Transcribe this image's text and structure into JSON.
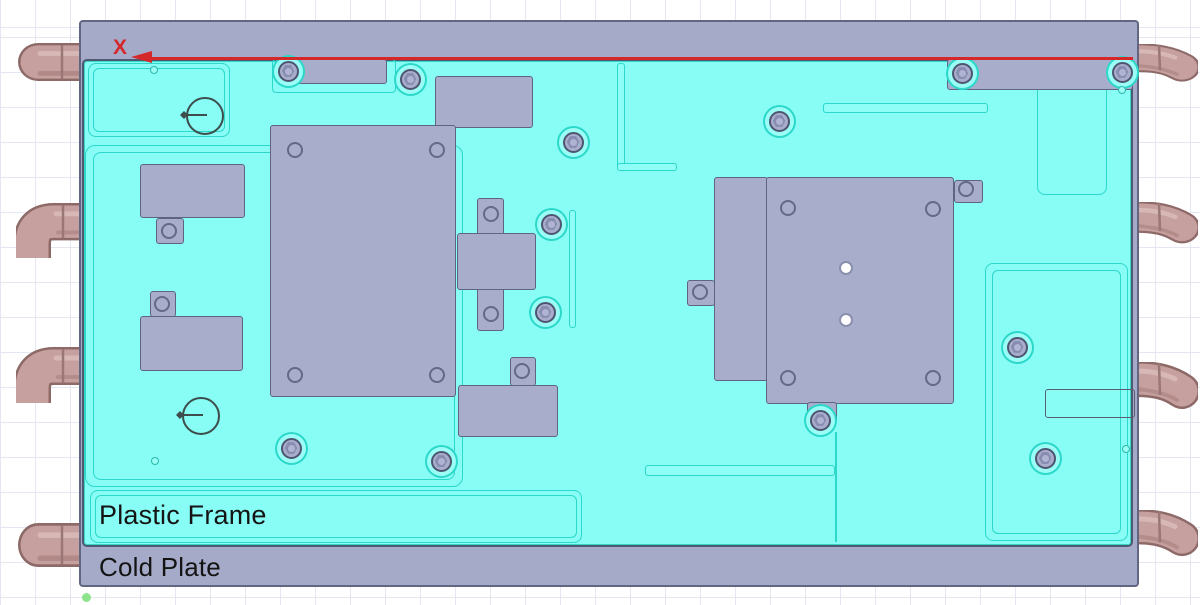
{
  "labels": {
    "plastic_frame": "Plastic Frame",
    "cold_plate": "Cold Plate",
    "axis_x": "X"
  },
  "colors": {
    "frame_cyan": "#87fdf5",
    "plate_gray": "#a5aac9",
    "component_gray": "#a8adcb",
    "pipe_body": "#c6a09e",
    "pipe_edge": "#8d6a68",
    "axis_red": "#d5282b",
    "outline_teal": "#2bd8ca",
    "outline_dark": "#5f6480",
    "grid_line": "#e4e6f2",
    "background": "#ffffff",
    "origin_green": "#7fe27f",
    "hole_white": "#ffffff"
  },
  "outlines": [
    {
      "name": "top-left-panel-outline",
      "x": 88,
      "y": 63,
      "w": 142,
      "h": 74,
      "r": 8
    },
    {
      "name": "top-left-panel-outline-inner",
      "x": 93,
      "y": 68,
      "w": 132,
      "h": 64,
      "r": 6
    },
    {
      "name": "top-mount-outline",
      "x": 272,
      "y": 59,
      "w": 124,
      "h": 34,
      "r": 4
    },
    {
      "name": "left-main-panel-outline",
      "x": 85,
      "y": 145,
      "w": 378,
      "h": 342,
      "r": 10
    },
    {
      "name": "left-main-panel-outline-inner",
      "x": 93,
      "y": 152,
      "w": 362,
      "h": 328,
      "r": 8
    },
    {
      "name": "label-panel-outline",
      "x": 90,
      "y": 490,
      "w": 492,
      "h": 53,
      "r": 8
    },
    {
      "name": "label-panel-outline-inner",
      "x": 95,
      "y": 495,
      "w": 482,
      "h": 43,
      "r": 6
    },
    {
      "name": "top-right-panel-outline",
      "x": 1037,
      "y": 63,
      "w": 70,
      "h": 132,
      "r": 8
    },
    {
      "name": "lower-right-panel-outline",
      "x": 985,
      "y": 263,
      "w": 143,
      "h": 278,
      "r": 8
    },
    {
      "name": "lower-right-panel-outline-inner",
      "x": 992,
      "y": 270,
      "w": 129,
      "h": 264,
      "r": 6
    }
  ],
  "slots": [
    {
      "name": "slot-top-right",
      "x": 823,
      "y": 103,
      "w": 165,
      "h": 10
    },
    {
      "name": "slot-bottom-middle",
      "x": 645,
      "y": 465,
      "w": 190,
      "h": 11
    },
    {
      "name": "slot-vertical",
      "x": 569,
      "y": 210,
      "w": 7,
      "h": 118
    },
    {
      "name": "l-wall-vertical",
      "x": 617,
      "y": 63,
      "w": 8,
      "h": 107
    },
    {
      "name": "l-wall-horizontal",
      "x": 617,
      "y": 163,
      "w": 60,
      "h": 8
    }
  ],
  "dark_slot": {
    "name": "vent-slot-outline",
    "x": 1045,
    "y": 389,
    "w": 90,
    "h": 29
  },
  "lines": [
    {
      "name": "right-module-divider",
      "x": 765,
      "y": 178,
      "w": 2,
      "h": 202,
      "color": "dark"
    },
    {
      "name": "bottom-panel-divider",
      "x": 835,
      "y": 432,
      "w": 2,
      "h": 110,
      "color": "teal"
    }
  ],
  "blocks": [
    {
      "name": "top-mount-block",
      "x": 278,
      "y": 59,
      "w": 109,
      "h": 25
    },
    {
      "name": "top-right-band",
      "x": 947,
      "y": 59,
      "w": 186,
      "h": 31
    },
    {
      "name": "upper-mid-block",
      "x": 435,
      "y": 76,
      "w": 98,
      "h": 52
    },
    {
      "name": "large-left-module",
      "x": 270,
      "y": 125,
      "w": 186,
      "h": 272
    },
    {
      "name": "cross-module-vertical",
      "x": 477,
      "y": 198,
      "w": 27,
      "h": 133
    },
    {
      "name": "cross-module-horizontal",
      "x": 457,
      "y": 233,
      "w": 79,
      "h": 57
    },
    {
      "name": "lower-ext-tab",
      "x": 510,
      "y": 357,
      "w": 26,
      "h": 29
    },
    {
      "name": "lower-ext-block",
      "x": 458,
      "y": 385,
      "w": 100,
      "h": 52
    },
    {
      "name": "small-block-upper",
      "x": 140,
      "y": 164,
      "w": 105,
      "h": 54
    },
    {
      "name": "small-block-upper-tab",
      "x": 156,
      "y": 218,
      "w": 28,
      "h": 26
    },
    {
      "name": "small-block-lower-tab",
      "x": 150,
      "y": 291,
      "w": 26,
      "h": 26
    },
    {
      "name": "small-block-lower",
      "x": 140,
      "y": 316,
      "w": 103,
      "h": 55
    },
    {
      "name": "right-module-left-strip",
      "x": 714,
      "y": 177,
      "w": 54,
      "h": 204
    },
    {
      "name": "right-module-main",
      "x": 766,
      "y": 177,
      "w": 188,
      "h": 227
    },
    {
      "name": "right-module-tab-top",
      "x": 954,
      "y": 180,
      "w": 29,
      "h": 23
    },
    {
      "name": "right-module-tab-left",
      "x": 687,
      "y": 280,
      "w": 28,
      "h": 26
    },
    {
      "name": "right-module-tab-bottom",
      "x": 807,
      "y": 402,
      "w": 30,
      "h": 21
    }
  ],
  "screws": [
    {
      "x": 288,
      "y": 71
    },
    {
      "x": 410,
      "y": 79
    },
    {
      "x": 962,
      "y": 73
    },
    {
      "x": 1122,
      "y": 72
    },
    {
      "x": 573,
      "y": 142
    },
    {
      "x": 779,
      "y": 121
    },
    {
      "x": 551,
      "y": 224
    },
    {
      "x": 545,
      "y": 312
    },
    {
      "x": 291,
      "y": 448
    },
    {
      "x": 441,
      "y": 461
    },
    {
      "x": 1017,
      "y": 347
    },
    {
      "x": 1045,
      "y": 458
    },
    {
      "x": 820,
      "y": 420
    }
  ],
  "holes": [
    {
      "x": 295,
      "y": 150
    },
    {
      "x": 437,
      "y": 150
    },
    {
      "x": 295,
      "y": 375
    },
    {
      "x": 437,
      "y": 375
    },
    {
      "x": 491,
      "y": 214
    },
    {
      "x": 491,
      "y": 314
    },
    {
      "x": 522,
      "y": 371
    },
    {
      "x": 169,
      "y": 231
    },
    {
      "x": 162,
      "y": 304
    },
    {
      "x": 788,
      "y": 208
    },
    {
      "x": 933,
      "y": 209
    },
    {
      "x": 788,
      "y": 378
    },
    {
      "x": 933,
      "y": 378
    },
    {
      "x": 700,
      "y": 292
    },
    {
      "x": 966,
      "y": 189
    }
  ],
  "white_holes": [
    {
      "x": 846,
      "y": 268
    },
    {
      "x": 846,
      "y": 320
    }
  ],
  "tiny_holes": [
    {
      "x": 154,
      "y": 70
    },
    {
      "x": 155,
      "y": 461
    },
    {
      "x": 1122,
      "y": 90
    },
    {
      "x": 1126,
      "y": 449
    }
  ],
  "datum_circles": [
    {
      "x": 205,
      "y": 116
    },
    {
      "x": 201,
      "y": 416
    }
  ],
  "pipes": {
    "left": [
      {
        "y": 43,
        "h": 38,
        "type": "straight"
      },
      {
        "y": 203,
        "h": 55,
        "type": "elbow-down"
      },
      {
        "y": 347,
        "h": 56,
        "type": "elbow-down"
      },
      {
        "y": 523,
        "h": 44,
        "type": "straight"
      }
    ],
    "right": [
      {
        "y": 44,
        "h": 40,
        "type": "elbow-out"
      },
      {
        "y": 202,
        "h": 44,
        "type": "elbow-out"
      },
      {
        "y": 362,
        "h": 50,
        "type": "elbow-out"
      },
      {
        "y": 510,
        "h": 49,
        "type": "elbow-out"
      }
    ]
  },
  "origin_dot": {
    "x": 82,
    "y": 593
  }
}
